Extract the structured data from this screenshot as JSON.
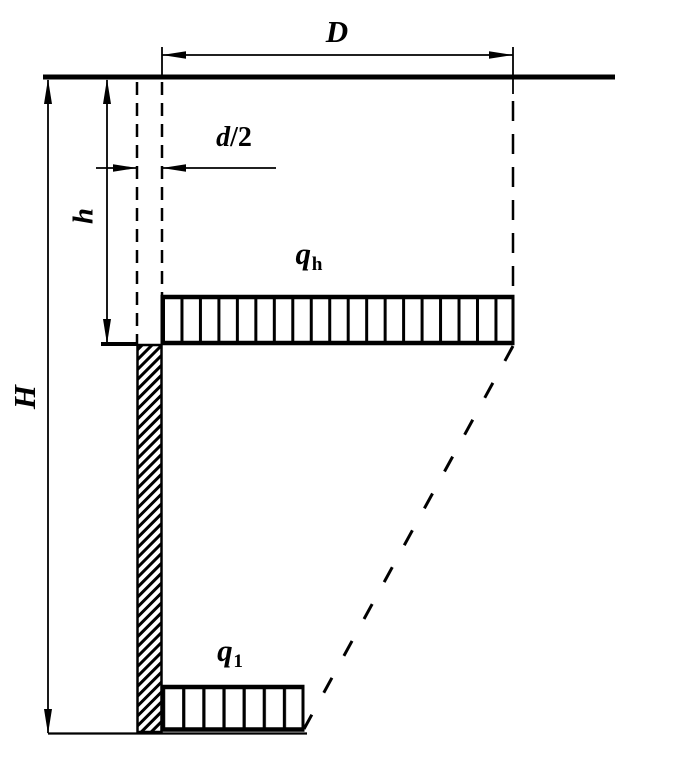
{
  "figure": {
    "type": "engineering-diagram",
    "description_visible_elements": "half-section diagram of a pile below ground surface with two distributed load bands",
    "colors": {
      "ink": "#000000",
      "background": "#ffffff"
    },
    "labels": {
      "D": "D",
      "d_over_2": {
        "base": "d",
        "suffix": "/2"
      },
      "h": "h",
      "H": "H",
      "q_h": {
        "base": "q",
        "sub": "h"
      },
      "q_1": {
        "base": "q",
        "sub": "1"
      }
    }
  }
}
